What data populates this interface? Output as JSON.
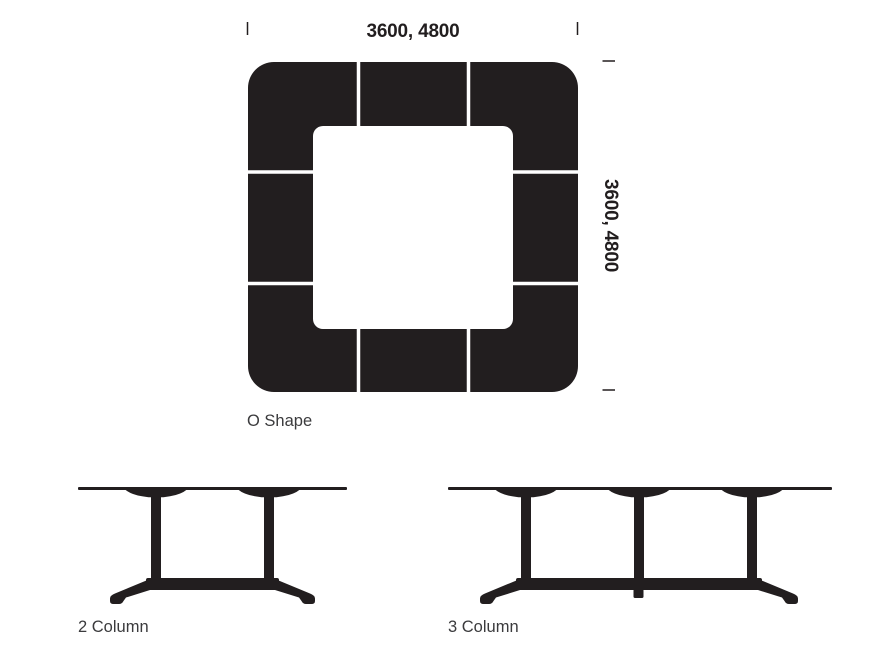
{
  "colors": {
    "ink": "#221e1f",
    "label_text": "#3b3b3d",
    "background": "#ffffff",
    "separator": "#ffffff"
  },
  "o_shape_diagram": {
    "label": "O Shape",
    "top_dimension": "3600, 4800",
    "side_dimension": "3600, 4800"
  },
  "elevation_diagrams": {
    "two_column": {
      "label": "2 Column",
      "columns": 2
    },
    "three_column": {
      "label": "3 Column",
      "columns": 3
    }
  }
}
